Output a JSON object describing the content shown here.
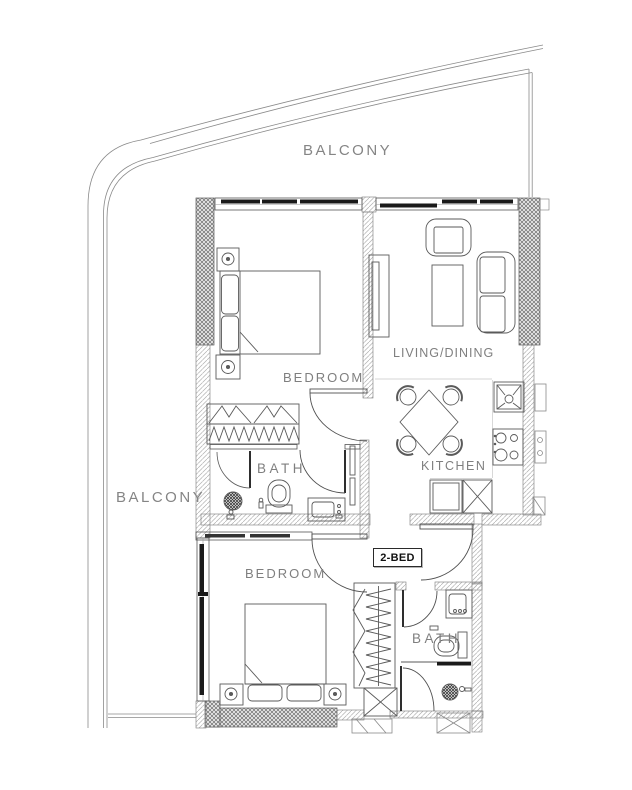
{
  "floorplan": {
    "type_label": "2-BED",
    "labels": {
      "balcony_top": "BALCONY",
      "balcony_left": "BALCONY",
      "bedroom_1": "BEDROOM",
      "living_dining": "LIVING/DINING",
      "kitchen": "KITCHEN",
      "bath_1": "BATH",
      "bedroom_2": "BEDROOM",
      "bath_2": "BATH"
    },
    "colors": {
      "line": "#4f4f4f",
      "structural_hatch": "#707070",
      "light_hatch": "#adadad",
      "window_glass": "#1a1a1a",
      "label_text": "#7f7f7f",
      "type_label_text": "#111111",
      "background": "#ffffff"
    }
  }
}
